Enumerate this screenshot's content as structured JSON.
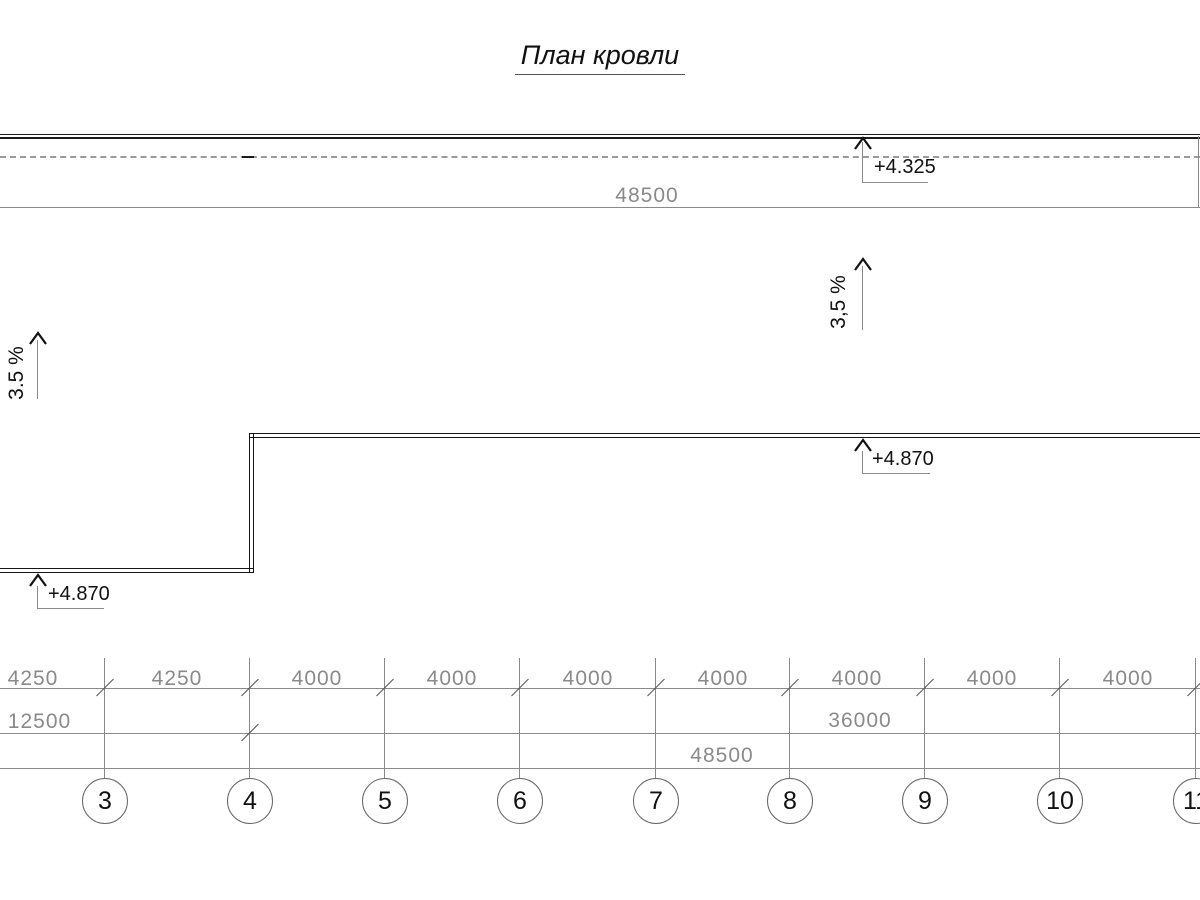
{
  "title": "План кровли",
  "top_area": {
    "overall_dim": "48500",
    "elevation": "+4.325"
  },
  "slopes": {
    "left": "3.5 %",
    "right": "3,5 %"
  },
  "roof": {
    "elevation_left": "+4.870",
    "elevation_right": "+4.870"
  },
  "dims": {
    "row1": [
      "4250",
      "4250",
      "4000",
      "4000",
      "4000",
      "4000",
      "4000",
      "4000",
      "4000"
    ],
    "row2_left": "12500",
    "row2_right": "36000",
    "row3": "48500"
  },
  "axes": [
    "3",
    "4",
    "5",
    "6",
    "7",
    "8",
    "9",
    "10",
    "11"
  ],
  "colors": {
    "drawing_line": "#1a1a1a",
    "dimension": "#8a8a8a",
    "dashed_axis": "#9a9a9a"
  }
}
